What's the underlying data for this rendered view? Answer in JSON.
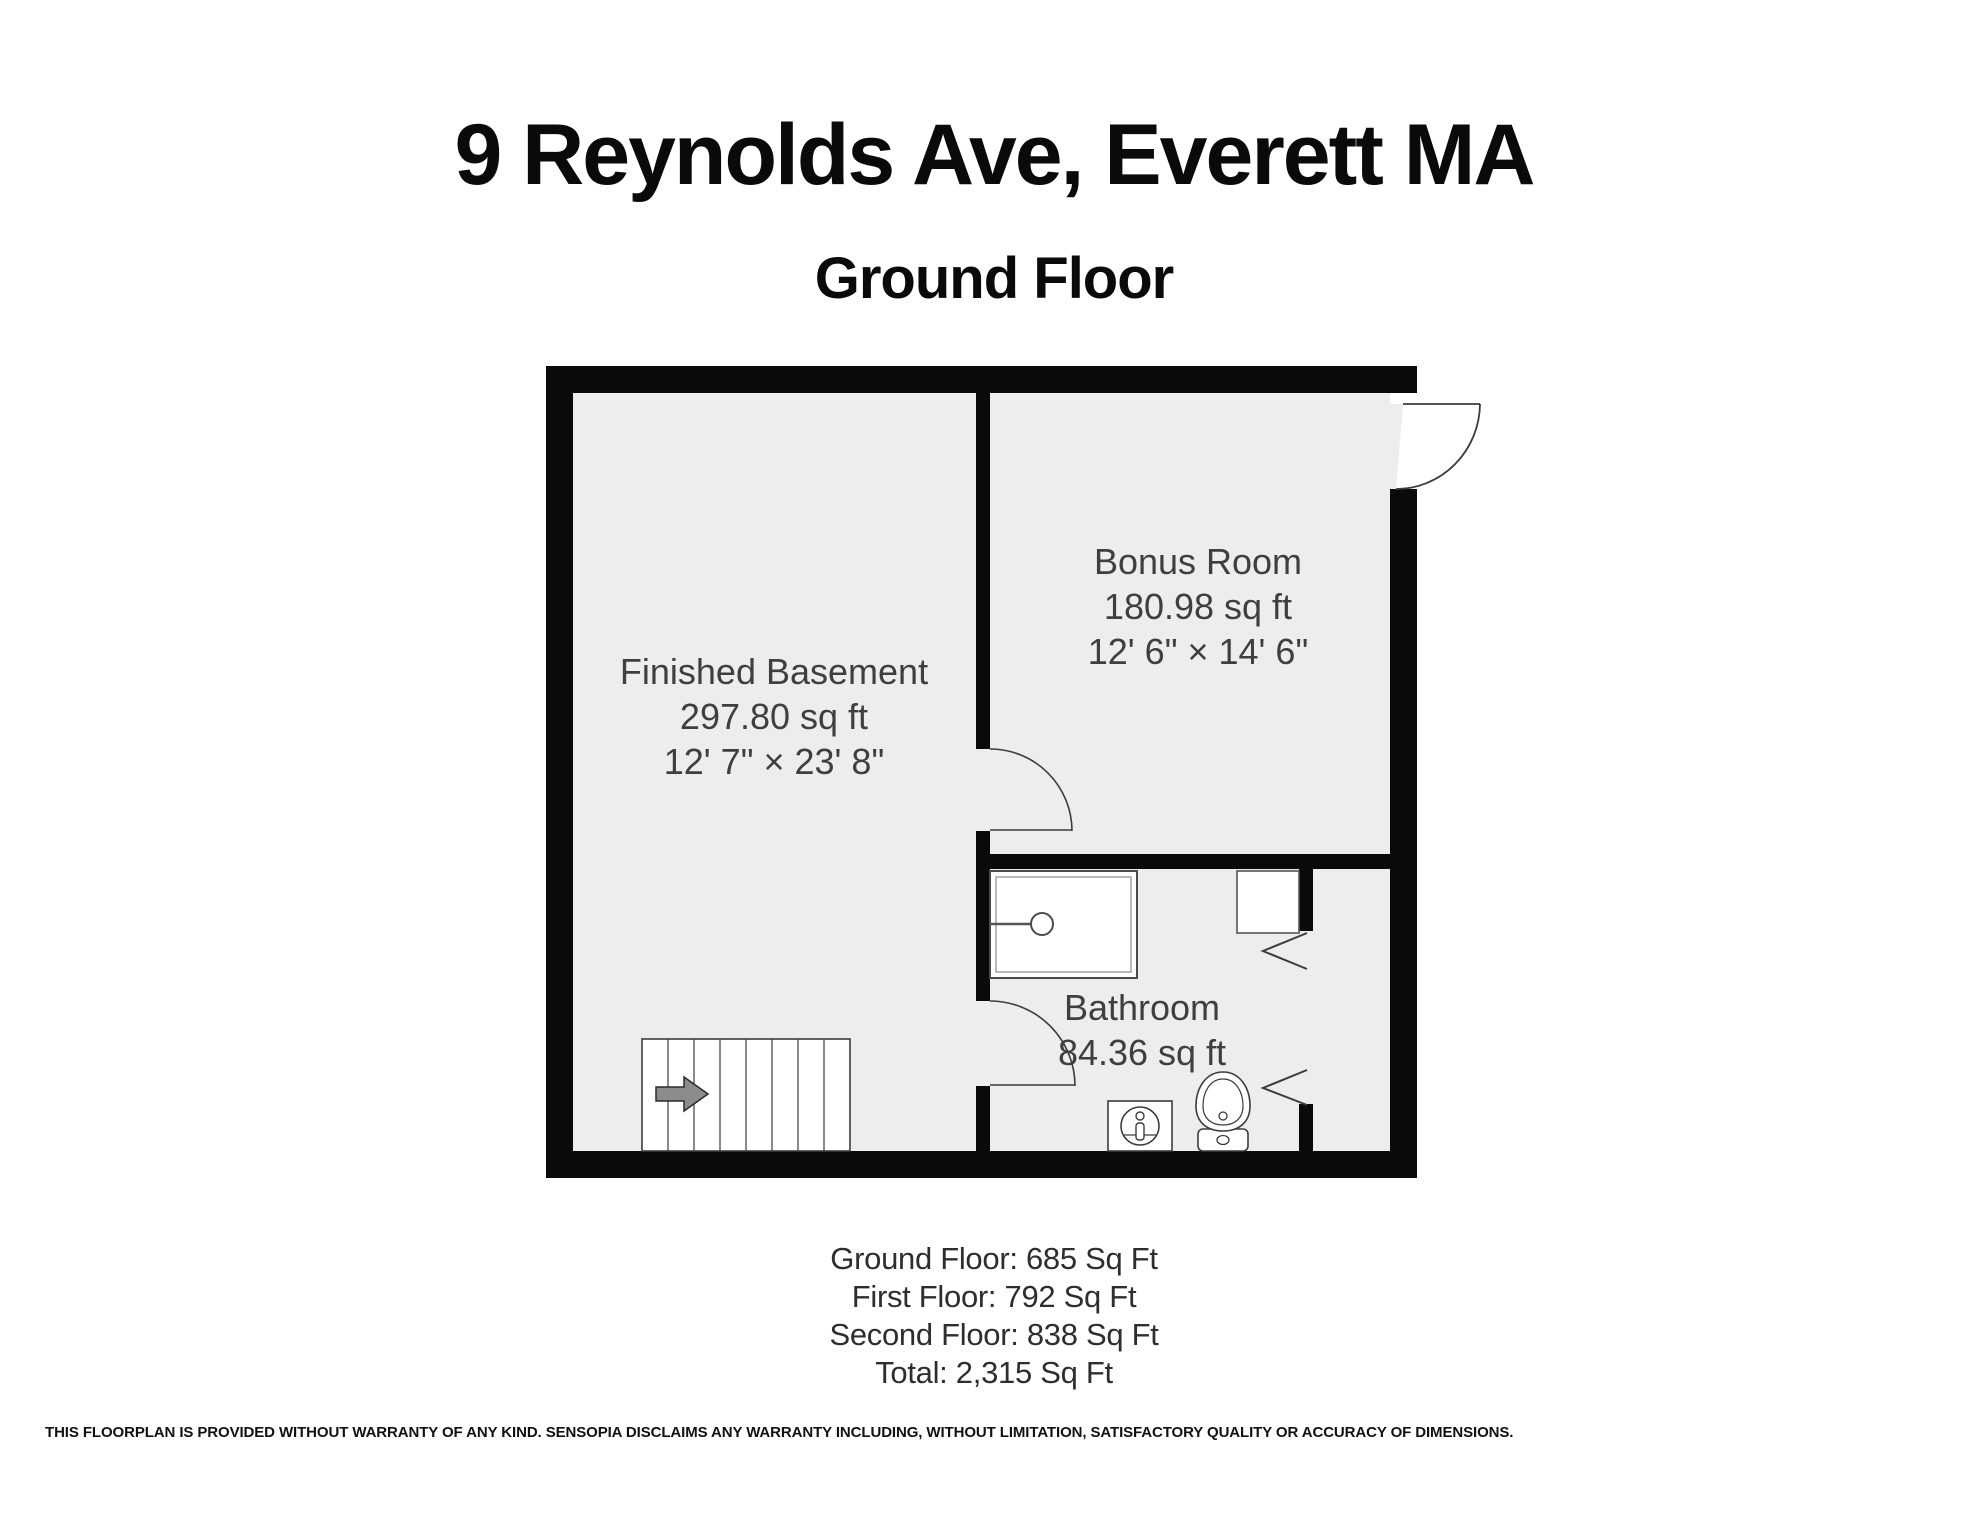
{
  "header": {
    "title": "9 Reynolds Ave, Everett MA",
    "subtitle": "Ground Floor"
  },
  "rooms": [
    {
      "name": "Finished Basement",
      "area": "297.80 sq ft",
      "dims": "12' 7\" × 23' 8\""
    },
    {
      "name": "Bonus Room",
      "area": "180.98 sq ft",
      "dims": "12' 6\" × 14' 6\""
    },
    {
      "name": "Bathroom",
      "area": "84.36 sq ft"
    }
  ],
  "summary": {
    "lines": [
      "Ground Floor: 685 Sq Ft",
      "First Floor: 792 Sq Ft",
      "Second Floor: 838 Sq Ft",
      "Total: 2,315 Sq Ft"
    ]
  },
  "disclaimer": "THIS FLOORPLAN IS PROVIDED WITHOUT WARRANTY OF ANY KIND. SENSOPIA DISCLAIMS ANY WARRANTY INCLUDING, WITHOUT LIMITATION, SATISFACTORY QUALITY OR ACCURACY OF DIMENSIONS.",
  "colors": {
    "wall": "#0a0a0a",
    "floor": "#ededed",
    "label": "#3f3f3f",
    "fixture_line": "#3c3c3c"
  }
}
